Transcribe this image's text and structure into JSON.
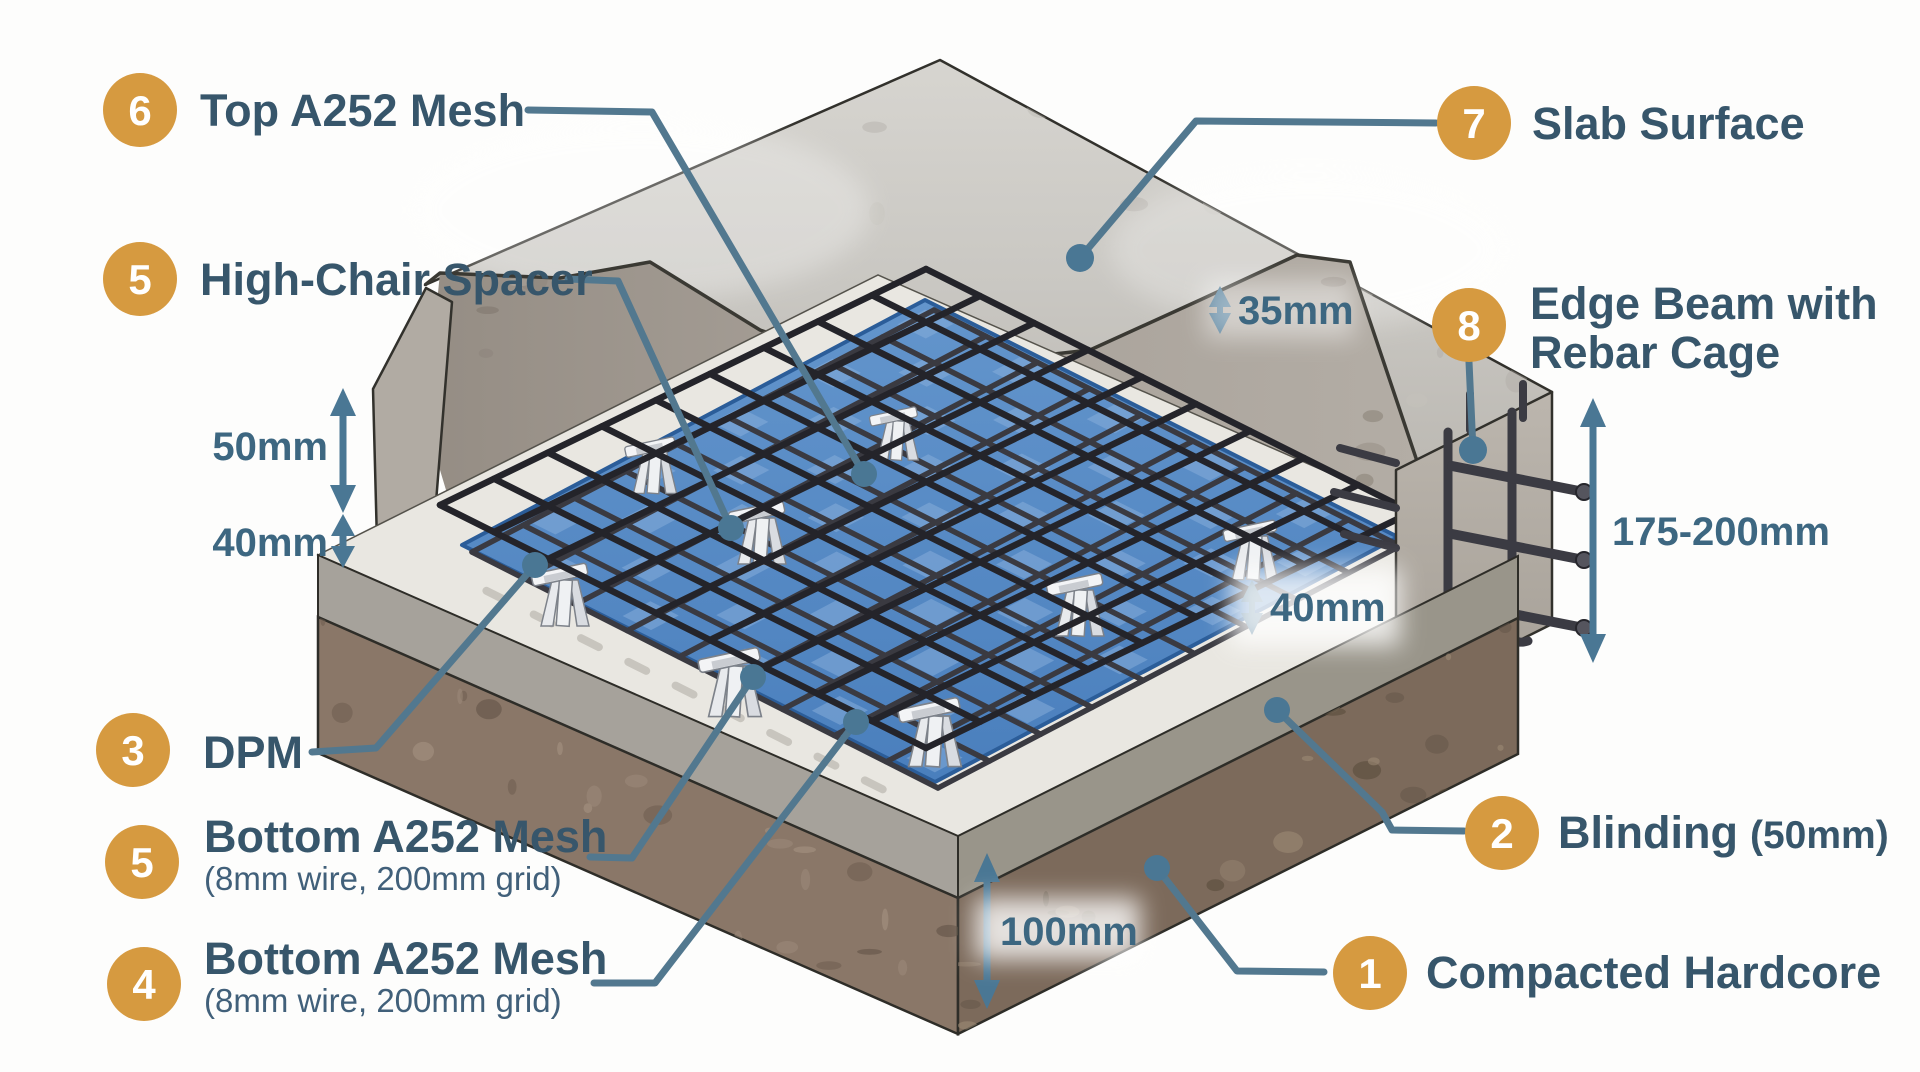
{
  "callouts": {
    "top_mesh": {
      "num": "6",
      "label": "Top A252 Mesh"
    },
    "high_chair_spacer": {
      "num": "5",
      "label": "High-Chair Spacer"
    },
    "slab_surface": {
      "num": "7",
      "label": "Slab Surface"
    },
    "edge_beam": {
      "num": "8",
      "label_line1": "Edge Beam with",
      "label_line2": "Rebar Cage"
    },
    "dpm": {
      "num": "3",
      "label": "DPM"
    },
    "bottom_mesh_upper": {
      "num": "5",
      "label": "Bottom A252 Mesh",
      "sublabel": "(8mm wire, 200mm grid)"
    },
    "bottom_mesh_lower": {
      "num": "4",
      "label": "Bottom A252 Mesh",
      "sublabel": "(8mm wire, 200mm grid)"
    },
    "blinding": {
      "num": "2",
      "label": "Blinding",
      "size_note": "(50mm)"
    },
    "compacted_hardcore": {
      "num": "1",
      "label": "Compacted Hardcore"
    }
  },
  "dimensions": {
    "top_cover": "35mm",
    "mesh_layer_gap": "50mm",
    "bottom_cover": "40mm",
    "dpm_to_mesh": "40mm",
    "edge_beam_depth": "175-200mm",
    "hardcore_depth": "100mm"
  },
  "colors": {
    "badge_orange": "#d69a40",
    "callout_text": "#37566b",
    "dimension_text": "#3d6781",
    "leader_line": "#52788f",
    "dpm_blue": "#4f85c2",
    "concrete_light": "#cbc9c4",
    "concrete_wall": "#a7a098",
    "blinding_gray": "#a6a29b",
    "hardcore_brown": "#887567",
    "mesh_steel": "#26262c"
  }
}
